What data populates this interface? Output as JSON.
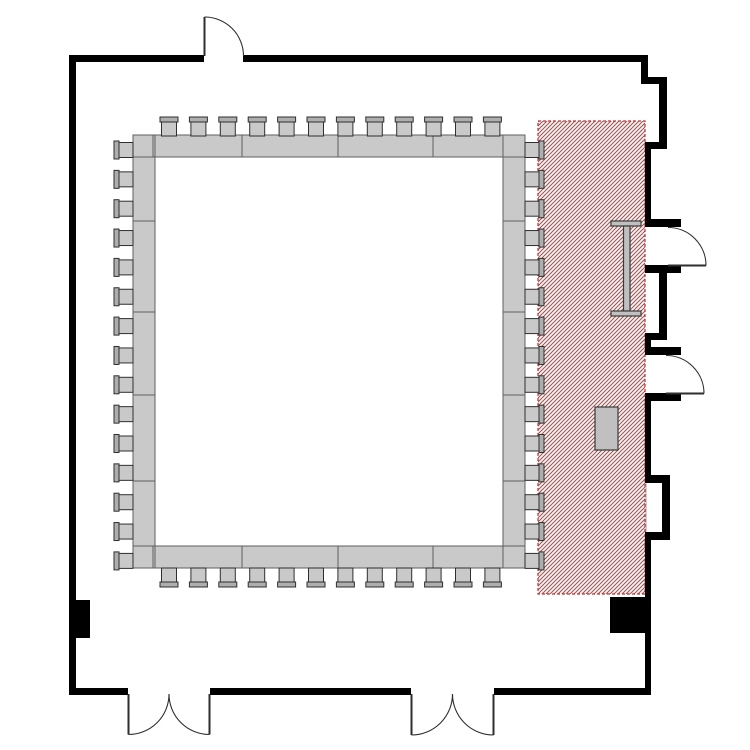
{
  "canvas": {
    "width": 750,
    "height": 750,
    "background": "#ffffff"
  },
  "colors": {
    "wall": "#000000",
    "door_line": "#2e2e2e",
    "table_fill": "#c9c9c9",
    "table_border": "#5f5f5f",
    "seat_fill": "#c9c9c9",
    "seat_border": "#2f2f2f",
    "back_fill": "#aeaeae",
    "back_border": "#2f2f2f",
    "hatch_line": "#9b5252",
    "hatch_bg": "#fbf6f5",
    "hatch_border": "#c23030",
    "furniture_fill": "#c0c0c0",
    "furniture_border": "#3a3a3a",
    "niche_fill": "#ffffff",
    "niche_border": "#a0a0a0"
  },
  "hatch_area": {
    "name": "hatched-zone",
    "x": 538,
    "y": 121,
    "width": 107,
    "height": 473
  },
  "niche": {
    "name": "wall-niche-interior",
    "x": 646,
    "y": 482,
    "width": 17,
    "height": 51
  },
  "walls": [
    {
      "name": "wall-top-left",
      "x": 69,
      "y": 55,
      "width": 135,
      "height": 7
    },
    {
      "name": "wall-top-right",
      "x": 243,
      "y": 55,
      "width": 405,
      "height": 7
    },
    {
      "name": "wall-left",
      "x": 69,
      "y": 55,
      "width": 7,
      "height": 640
    },
    {
      "name": "wall-bottom-1",
      "x": 69,
      "y": 688,
      "width": 59,
      "height": 7
    },
    {
      "name": "wall-bottom-2",
      "x": 210,
      "y": 688,
      "width": 201,
      "height": 7
    },
    {
      "name": "wall-bottom-3",
      "x": 494,
      "y": 688,
      "width": 157,
      "height": 7
    },
    {
      "name": "wall-right-jog-1",
      "x": 641,
      "y": 60,
      "width": 7,
      "height": 20
    },
    {
      "name": "wall-right-jog-2",
      "x": 641,
      "y": 77,
      "width": 26,
      "height": 7
    },
    {
      "name": "wall-right-upper",
      "x": 659,
      "y": 77,
      "width": 8,
      "height": 68
    },
    {
      "name": "wall-right-step-1",
      "x": 645,
      "y": 142,
      "width": 22,
      "height": 7
    },
    {
      "name": "wall-right-a",
      "x": 645,
      "y": 142,
      "width": 6,
      "height": 79
    },
    {
      "name": "door1-jamb-top",
      "x": 645,
      "y": 219,
      "width": 36,
      "height": 8
    },
    {
      "name": "door1-jamb-bottom",
      "x": 645,
      "y": 265,
      "width": 36,
      "height": 8
    },
    {
      "name": "wall-right-b",
      "x": 659,
      "y": 273,
      "width": 8,
      "height": 65
    },
    {
      "name": "wall-right-step-2",
      "x": 645,
      "y": 333,
      "width": 22,
      "height": 7
    },
    {
      "name": "wall-right-c",
      "x": 645,
      "y": 333,
      "width": 6,
      "height": 16
    },
    {
      "name": "door2-jamb-top",
      "x": 645,
      "y": 347,
      "width": 36,
      "height": 8
    },
    {
      "name": "door2-jamb-bottom",
      "x": 645,
      "y": 393,
      "width": 36,
      "height": 8
    },
    {
      "name": "wall-right-d",
      "x": 645,
      "y": 401,
      "width": 6,
      "height": 76
    },
    {
      "name": "wall-niche-top",
      "x": 645,
      "y": 475,
      "width": 25,
      "height": 8
    },
    {
      "name": "wall-niche-right",
      "x": 662,
      "y": 475,
      "width": 8,
      "height": 65
    },
    {
      "name": "wall-niche-bottom",
      "x": 645,
      "y": 532,
      "width": 25,
      "height": 8
    },
    {
      "name": "wall-right-e",
      "x": 645,
      "y": 540,
      "width": 6,
      "height": 155
    }
  ],
  "columns": [
    {
      "name": "column-left",
      "x": 69,
      "y": 600,
      "width": 21,
      "height": 38
    },
    {
      "name": "column-right",
      "x": 610,
      "y": 597,
      "width": 41,
      "height": 36
    }
  ],
  "table_square": {
    "name": "hollow-square-table",
    "x": 133,
    "y": 135,
    "width": 392,
    "height": 433,
    "thickness": 22,
    "top_bottom_seams": [
      153,
      242,
      338,
      433,
      503
    ],
    "side_seams": [
      157,
      221,
      312,
      395,
      481,
      546
    ]
  },
  "chairs": {
    "size": {
      "width": 18,
      "seat": 15,
      "back": 5
    },
    "rows": [
      {
        "name": "chairs-top",
        "side": "top",
        "count": 12,
        "start": 160,
        "pitch": 29.4,
        "edge": 117
      },
      {
        "name": "chairs-bottom",
        "side": "bottom",
        "count": 12,
        "start": 160,
        "pitch": 29.4,
        "edge": 568
      },
      {
        "name": "chairs-left",
        "side": "left",
        "count": 15,
        "start": 141,
        "pitch": 29.35,
        "edge": 114
      },
      {
        "name": "chairs-right",
        "side": "right",
        "count": 15,
        "start": 141,
        "pitch": 29.35,
        "edge": 525
      }
    ]
  },
  "furniture": [
    {
      "name": "ibeam-table-top",
      "x": 611,
      "y": 221,
      "width": 30,
      "height": 5
    },
    {
      "name": "ibeam-table-stem",
      "x": 623.5,
      "y": 226,
      "width": 6.5,
      "height": 85
    },
    {
      "name": "ibeam-table-bottom",
      "x": 611,
      "y": 311,
      "width": 30,
      "height": 5
    },
    {
      "name": "service-table",
      "x": 595,
      "y": 407,
      "width": 23,
      "height": 43
    }
  ],
  "doors": [
    {
      "name": "door-top",
      "leaf": [
        204.5,
        56,
        204.5,
        17
      ],
      "arc": {
        "r": 39,
        "from": [
          204.5,
          17
        ],
        "to": [
          243.5,
          56
        ],
        "sweep": 1
      }
    },
    {
      "name": "door-right-upper",
      "leaf": [
        668,
        265.5,
        706,
        265.5
      ],
      "arc": {
        "r": 38,
        "from": [
          706,
          265.5
        ],
        "to": [
          668,
          227.5
        ],
        "sweep": 0
      }
    },
    {
      "name": "door-right-lower",
      "leaf": [
        666,
        393.5,
        704,
        393.5
      ],
      "arc": {
        "r": 38,
        "from": [
          704,
          393.5
        ],
        "to": [
          666,
          355.5
        ],
        "sweep": 0
      }
    },
    {
      "name": "double-door-left-leaf-a",
      "leaf": [
        128.5,
        694,
        128.5,
        734.5
      ],
      "arc": {
        "r": 40.5,
        "from": [
          128.5,
          734.5
        ],
        "to": [
          169,
          694
        ],
        "sweep": 0
      }
    },
    {
      "name": "double-door-left-leaf-b",
      "leaf": [
        209.5,
        694,
        209.5,
        734.5
      ],
      "arc": {
        "r": 40.5,
        "from": [
          209.5,
          734.5
        ],
        "to": [
          169,
          694
        ],
        "sweep": 1
      }
    },
    {
      "name": "double-door-right-leaf-a",
      "leaf": [
        411.5,
        694,
        411.5,
        735
      ],
      "arc": {
        "r": 41,
        "from": [
          411.5,
          735
        ],
        "to": [
          452.5,
          694
        ],
        "sweep": 0
      }
    },
    {
      "name": "double-door-right-leaf-b",
      "leaf": [
        493.5,
        694,
        493.5,
        735
      ],
      "arc": {
        "r": 41,
        "from": [
          493.5,
          735
        ],
        "to": [
          452.5,
          694
        ],
        "sweep": 1
      }
    }
  ]
}
